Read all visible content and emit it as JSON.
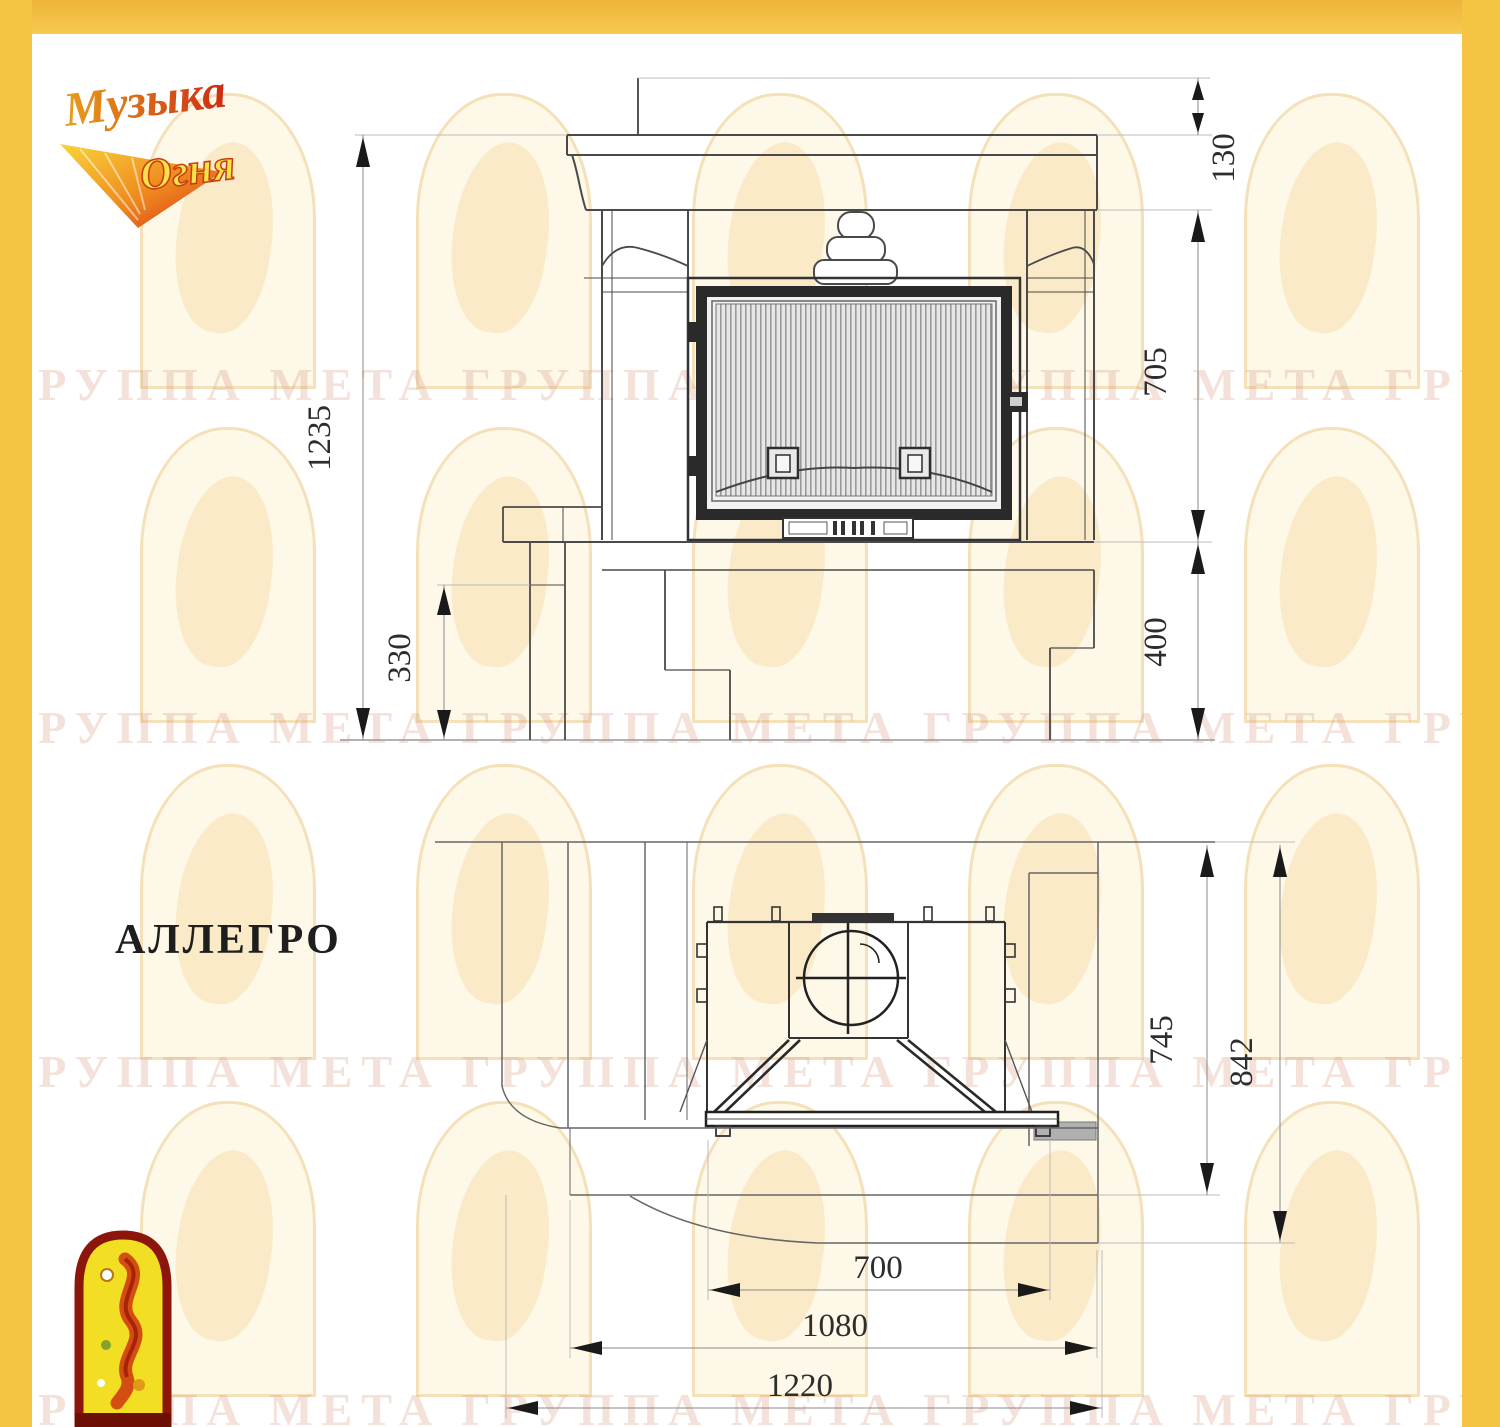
{
  "model_label": "АЛЛЕГРО",
  "brand_logo": {
    "line1": "Музыка",
    "line2": "Огня"
  },
  "watermark": {
    "text": "ГРУППА МЕТА"
  },
  "front_view": {
    "title": "front elevation of fireplace",
    "dimensions": {
      "total_height": "1235",
      "hearth_ledge_height": "330",
      "mantel_top_offset": "130",
      "opening_height": "705",
      "base_height": "400"
    }
  },
  "plan_view": {
    "title": "top plan of fireplace",
    "dimensions": {
      "body_depth": "745",
      "total_depth": "842",
      "firebox_width": "700",
      "body_width": "1080",
      "total_width": "1220"
    }
  },
  "colors": {
    "frame_yellow": "#f5c443",
    "drawing_line": "#4a4a4a",
    "door_frame_dark": "#2a2a2a",
    "emblem_red": "#8c150c",
    "emblem_yellow": "#f2de22"
  }
}
